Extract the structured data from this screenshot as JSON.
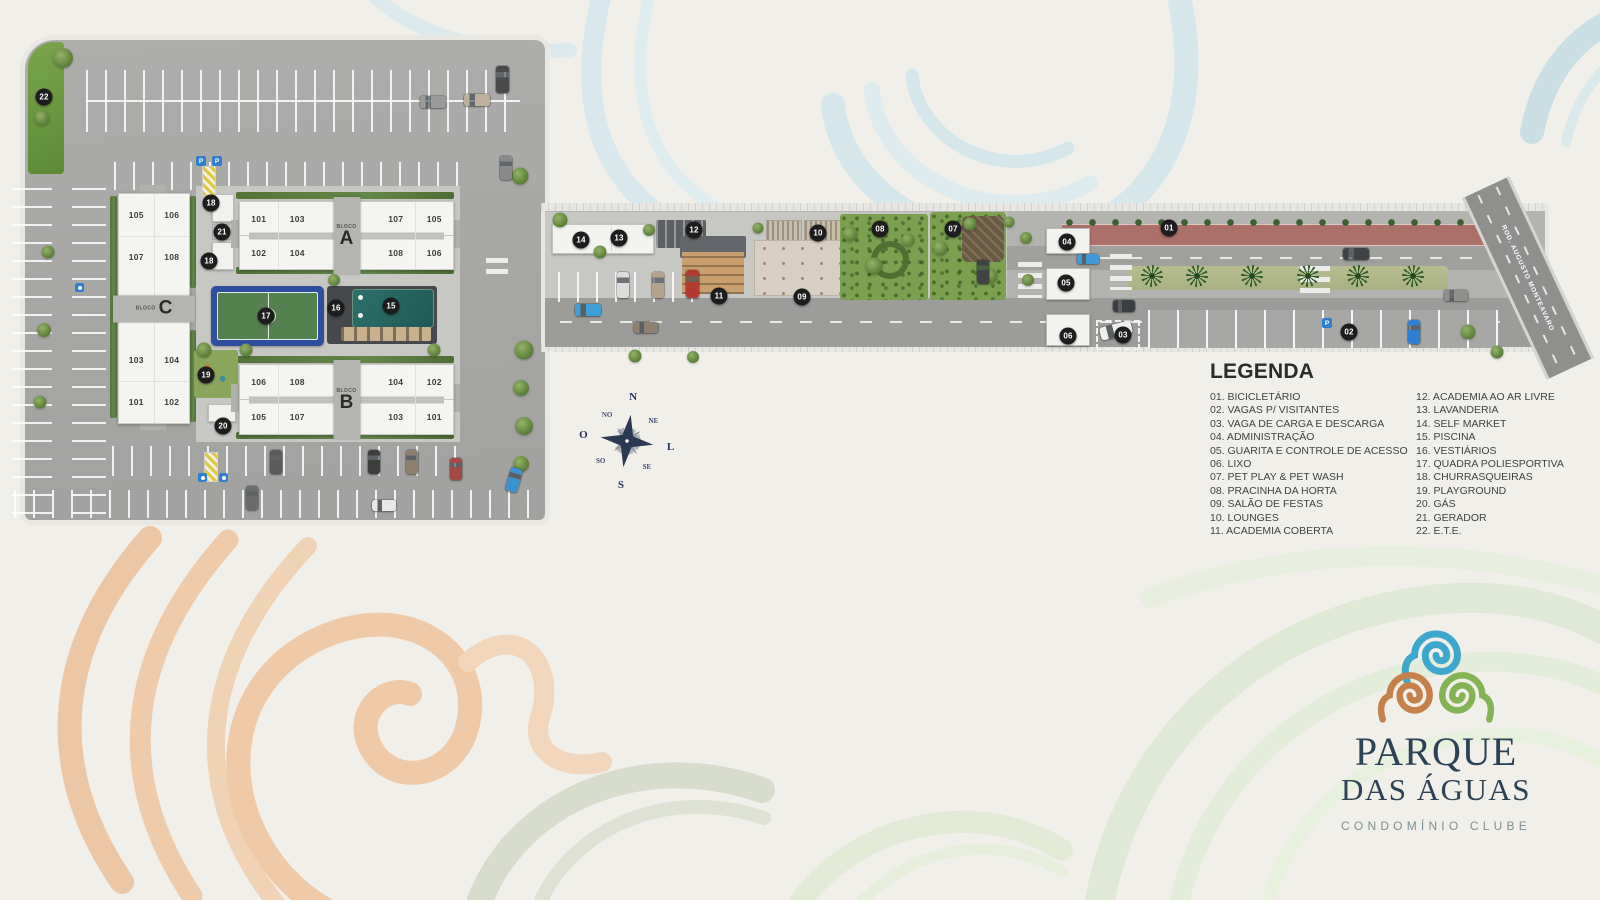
{
  "page": {
    "background": "#f1efe9"
  },
  "site_plan": {
    "street_name": "ROD. AUGUSTO MONTEAVARO",
    "sign_p": "P",
    "blocks": {
      "a": {
        "bloco_word": "BLOCO",
        "letter": "A",
        "units_top": [
          "101",
          "103",
          "107",
          "105"
        ],
        "units_bottom": [
          "102",
          "104",
          "108",
          "106"
        ]
      },
      "b": {
        "bloco_word": "BLOCO",
        "letter": "B",
        "units_top": [
          "106",
          "108",
          "104",
          "102"
        ],
        "units_bottom": [
          "105",
          "107",
          "103",
          "101"
        ]
      },
      "c": {
        "bloco_word": "BLOCO",
        "letter": "C",
        "units_left": [
          "105",
          "107",
          "103",
          "101"
        ],
        "units_right": [
          "106",
          "108",
          "104",
          "102"
        ]
      }
    },
    "markers": [
      {
        "num": "22",
        "x": 44,
        "y": 97
      },
      {
        "num": "18",
        "x": 211,
        "y": 203
      },
      {
        "num": "21",
        "x": 222,
        "y": 232
      },
      {
        "num": "18",
        "x": 209,
        "y": 261
      },
      {
        "num": "17",
        "x": 266,
        "y": 316
      },
      {
        "num": "16",
        "x": 336,
        "y": 308
      },
      {
        "num": "15",
        "x": 391,
        "y": 306
      },
      {
        "num": "19",
        "x": 206,
        "y": 375
      },
      {
        "num": "20",
        "x": 223,
        "y": 426
      },
      {
        "num": "14",
        "x": 581,
        "y": 240
      },
      {
        "num": "13",
        "x": 619,
        "y": 238
      },
      {
        "num": "12",
        "x": 694,
        "y": 230
      },
      {
        "num": "11",
        "x": 719,
        "y": 296
      },
      {
        "num": "10",
        "x": 818,
        "y": 233
      },
      {
        "num": "09",
        "x": 802,
        "y": 297
      },
      {
        "num": "08",
        "x": 880,
        "y": 229
      },
      {
        "num": "07",
        "x": 953,
        "y": 229
      },
      {
        "num": "04",
        "x": 1067,
        "y": 242
      },
      {
        "num": "05",
        "x": 1066,
        "y": 283
      },
      {
        "num": "06",
        "x": 1068,
        "y": 336
      },
      {
        "num": "03",
        "x": 1123,
        "y": 335
      },
      {
        "num": "01",
        "x": 1169,
        "y": 228
      },
      {
        "num": "02",
        "x": 1349,
        "y": 332
      }
    ],
    "accent_colors": {
      "marker_bg": "#1d1d1d",
      "court_blue": "#2e4f9e",
      "court_green": "#55804f",
      "pool_teal": "#235e5a",
      "bike_lane_red": "#ab7169"
    }
  },
  "compass": {
    "points": [
      "N",
      "NE",
      "L",
      "SE",
      "S",
      "SO",
      "O",
      "NO"
    ]
  },
  "legend": {
    "title": "LEGENDA",
    "column1": [
      "01. BICICLETÁRIO",
      "02. VAGAS P/ VISITANTES",
      "03. VAGA DE CARGA E DESCARGA",
      "04. ADMINISTRAÇÃO",
      "05. GUARITA E CONTROLE DE ACESSO",
      "06. LIXO",
      "07. PET PLAY & PET WASH",
      "08. PRACINHA DA HORTA",
      "09. SALÃO DE FESTAS",
      "10. LOUNGES",
      "11. ACADEMIA COBERTA"
    ],
    "column2": [
      "12. ACADEMIA AO AR LIVRE",
      "13. LAVANDERIA",
      "14. SELF MARKET",
      "15. PISCINA",
      "16. VESTIÁRIOS",
      "17. QUADRA POLIESPORTIVA",
      "18. CHURRASQUEIRAS",
      "19. PLAYGROUND",
      "20. GÁS",
      "21. GERADOR",
      "22. E.T.E."
    ]
  },
  "logo": {
    "name_line1": "PARQUE",
    "name_line2": "DAS ÁGUAS",
    "tagline": "CONDOMÍNIO CLUBE",
    "spiral_colors": {
      "top": "#3ea7cc",
      "left": "#c6804b",
      "right": "#84b356"
    }
  }
}
